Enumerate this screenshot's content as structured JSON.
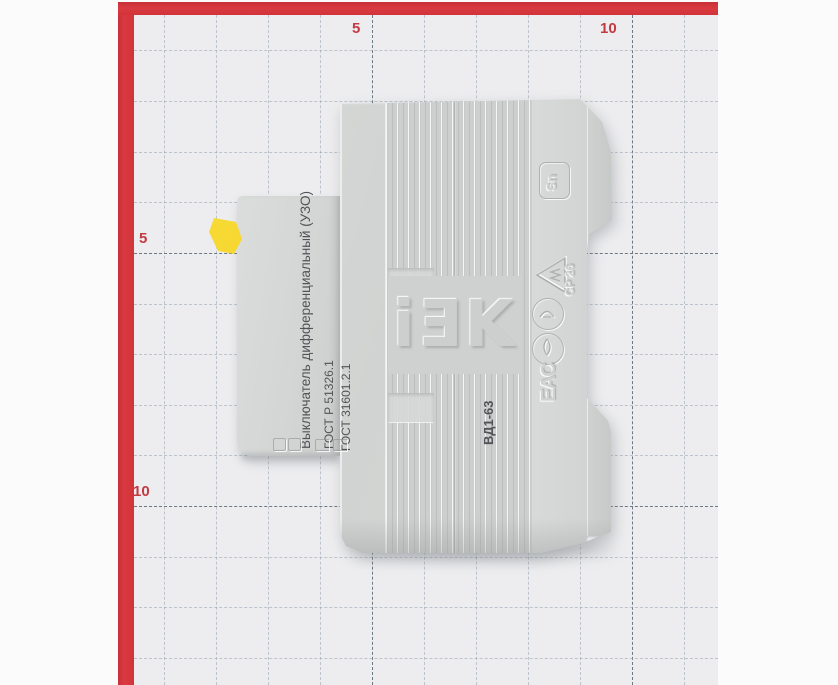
{
  "frame": {
    "color": "#d6353d"
  },
  "ruler": {
    "top_5": "5",
    "top_10": "10",
    "left_5": "5",
    "left_10": "10"
  },
  "device": {
    "logo": "iƎK",
    "front_text": {
      "line1": "ВД1-63",
      "line2": "Выключатель дифференциальный (УЗО)"
    },
    "gost_text": {
      "line1": "ГОСТ Р 51326.1",
      "line2": "ГОСТ 31601.2.1"
    },
    "marks": {
      "sn": "Sn",
      "cp": "СР 26",
      "eac": "ЕАС"
    },
    "colors": {
      "body": "#d2d4d3",
      "toggle": "#f2cd1d",
      "ink": "#515456"
    }
  }
}
